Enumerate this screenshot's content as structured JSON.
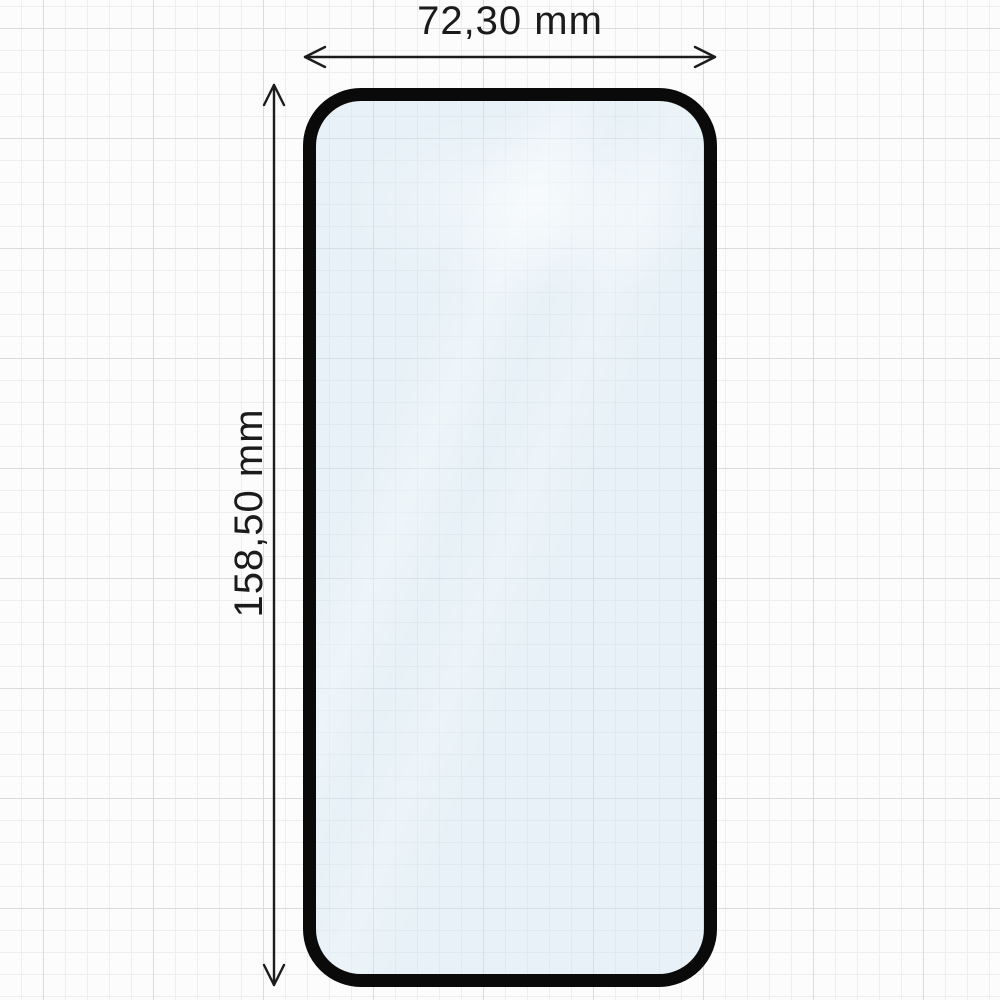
{
  "diagram": {
    "type": "dimension-diagram",
    "subject": "phone-screen-protector-tempered-glass",
    "width_dimension": {
      "label": "72,30 mm",
      "value_mm": 72.3,
      "orientation": "horizontal"
    },
    "height_dimension": {
      "label": "158,50 mm",
      "value_mm": 158.5,
      "orientation": "vertical"
    },
    "colors": {
      "paper": "#fcfcfc",
      "grid_minor": "#eceeef",
      "grid_major": "#d9dcde",
      "glass_border": "#0a0a0a",
      "glass_tint": "#d3e5f1",
      "annotation_ink": "#1b1b1b"
    }
  }
}
